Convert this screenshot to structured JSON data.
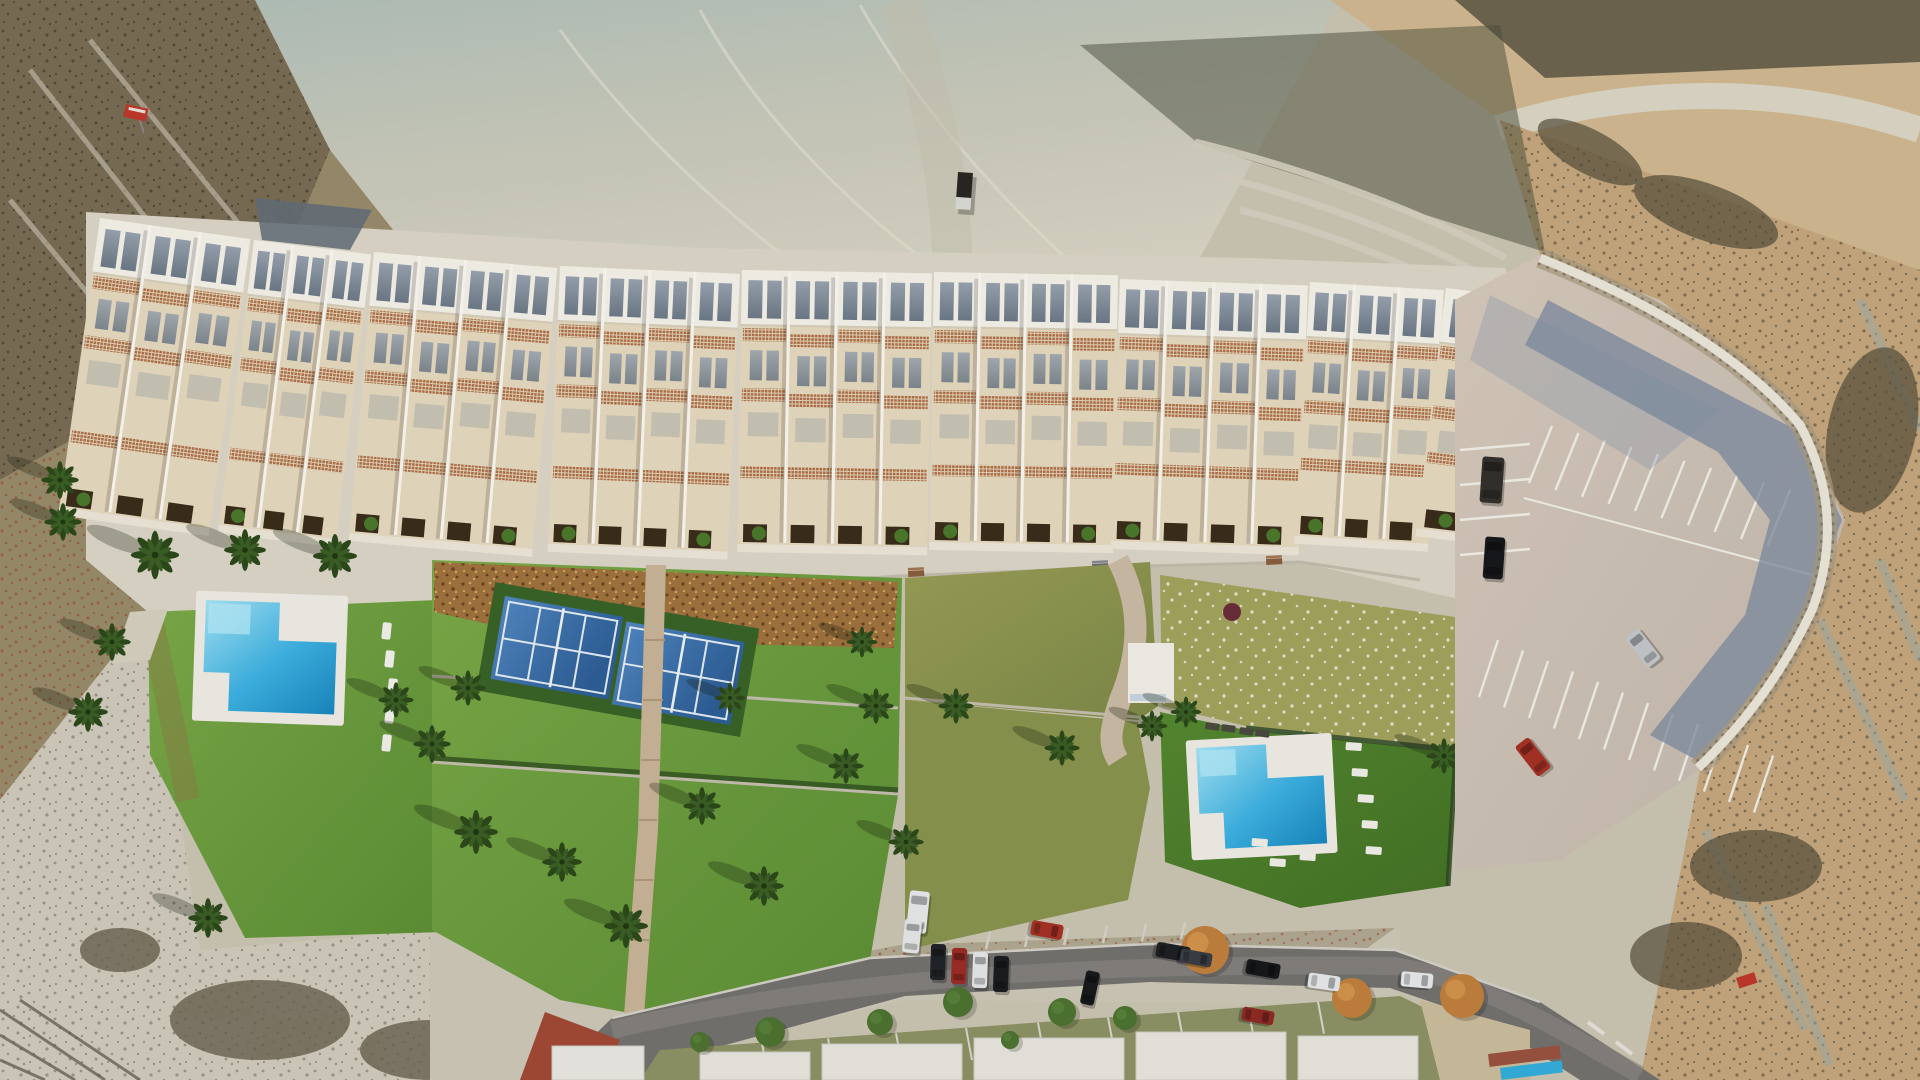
{
  "scene": {
    "type": "aerial-architectural-render",
    "setting": "arid badlands hillside with new residential development",
    "development": {
      "residential_blocks": 9,
      "swimming_pools": 2,
      "padel_courts": 2,
      "promenade_benches": 7,
      "sun_loungers": 14,
      "palm_trees": 26,
      "parking_lot_cars": 4
    },
    "existing_street": {
      "parked_cars": 14,
      "row_houses": 5
    },
    "vehicles": {
      "dirt_track_truck": 1
    },
    "signs": {
      "red_site_signs": 2
    },
    "palette": {
      "terrain_sand": "#cdc6b3",
      "terrain_wash_blue": "#b9c6bf",
      "terrain_wash_light": "#dcd9c8",
      "terrain_ridge_tan": "#d3bb92",
      "terrain_scrub_dark": "#6e6450",
      "rust_speckle": "#9c5636",
      "lawn_bright": "#6fa33f",
      "lawn_deep": "#4f7d30",
      "lawn_dry_olive": "#96a05a",
      "mulch_brown": "#a1743f",
      "pool_water_light": "#a6e6f8",
      "pool_water_deep": "#1a88c0",
      "pool_deck_white": "#f1efe6",
      "padel_court_blue": "#4a82ba",
      "building_roof_white": "#f7f4ec",
      "building_wall_cream": "#e8dbc0",
      "pergola_brown": "#b0714a",
      "window_glass_slate": "#77828f",
      "promenade_grey": "#ded8c9",
      "path_beige": "#c9b69a",
      "parking_surface": "#cfc2b4",
      "wall_white": "#eee9dc",
      "wall_shadow_blue": "#7e8ca2",
      "street_asphalt": "#757370",
      "sidewalk_brick_red": "#a34a36",
      "car_red": "#a83226",
      "car_black": "#17181c",
      "car_white": "#e9ebec",
      "car_silver": "#c6c9cd",
      "autumn_tree": "#c2813e",
      "palm_green": "#2d4a1c"
    }
  }
}
